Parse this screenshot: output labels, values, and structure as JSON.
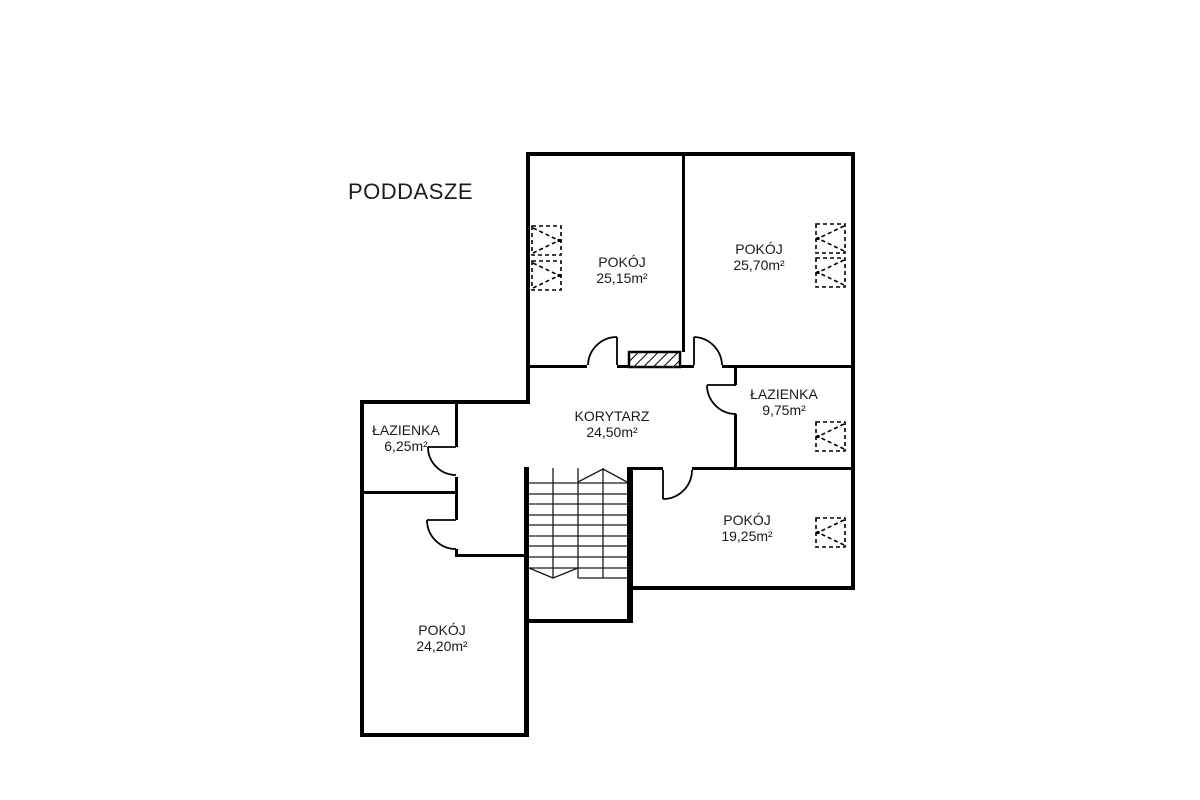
{
  "title": "PODDASZE",
  "floor_plan": {
    "rooms": [
      {
        "id": "pokoj-1",
        "name": "POKÓJ",
        "area": "25,15m²"
      },
      {
        "id": "pokoj-2",
        "name": "POKÓJ",
        "area": "25,70m²"
      },
      {
        "id": "lazienka-duza",
        "name": "ŁAZIENKA",
        "area": "9,75m²"
      },
      {
        "id": "korytarz",
        "name": "KORYTARZ",
        "area": "24,50m²"
      },
      {
        "id": "lazienka-mala",
        "name": "ŁAZIENKA",
        "area": "6,25m²"
      },
      {
        "id": "pokoj-3",
        "name": "POKÓJ",
        "area": "19,25m²"
      },
      {
        "id": "pokoj-4",
        "name": "POKÓJ",
        "area": "24,20m²"
      }
    ],
    "features": {
      "skylight_count": 6,
      "door_count": 6,
      "staircase": "switchback-stairs",
      "chimney": "hatched-shaft"
    },
    "colors": {
      "walls": "#000000",
      "background": "#ffffff",
      "text": "#1a1a1a"
    }
  }
}
